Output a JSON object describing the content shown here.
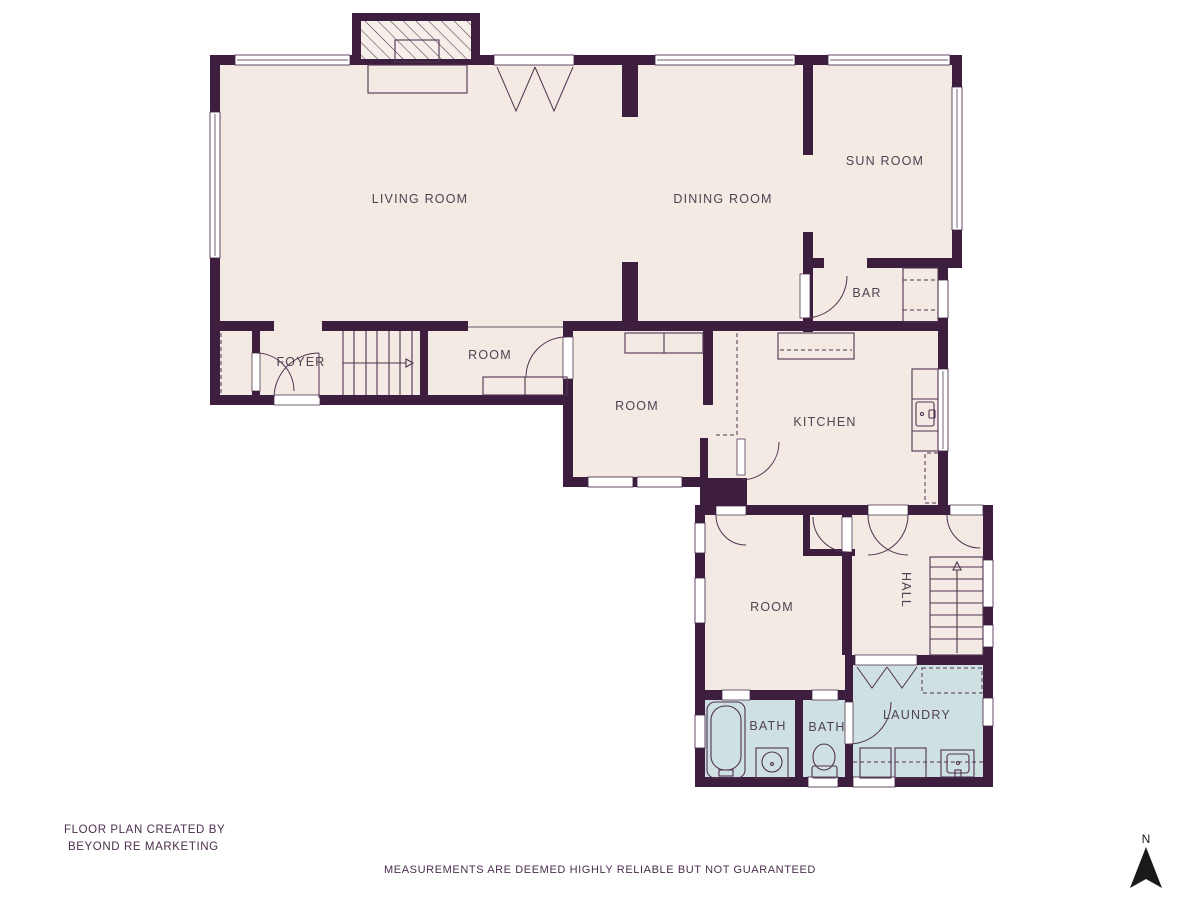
{
  "colors": {
    "background": "#ffffff",
    "wall": "#3d1e3e",
    "floor": "#f2eae3",
    "wet_floor": "#cfe0e3",
    "fixture_line": "#503250",
    "label_text": "#514253",
    "footer_text": "#4b2d4e",
    "compass": "#1a1a1a"
  },
  "rooms": [
    {
      "label": "LIVING ROOM"
    },
    {
      "label": "DINING ROOM"
    },
    {
      "label": "SUN ROOM"
    },
    {
      "label": "BAR"
    },
    {
      "label": "FOYER"
    },
    {
      "label": "ROOM"
    },
    {
      "label": "ROOM"
    },
    {
      "label": "KITCHEN"
    },
    {
      "label": "ROOM"
    },
    {
      "label": "HALL"
    },
    {
      "label": "BATH"
    },
    {
      "label": "BATH"
    },
    {
      "label": "LAUNDRY"
    }
  ],
  "footer": {
    "credit_line1": "FLOOR PLAN CREATED BY",
    "credit_line2": "BEYOND RE MARKETING",
    "disclaimer": "MEASUREMENTS ARE DEEMED HIGHLY RELIABLE BUT NOT GUARANTEED"
  },
  "compass": {
    "label": "N"
  }
}
